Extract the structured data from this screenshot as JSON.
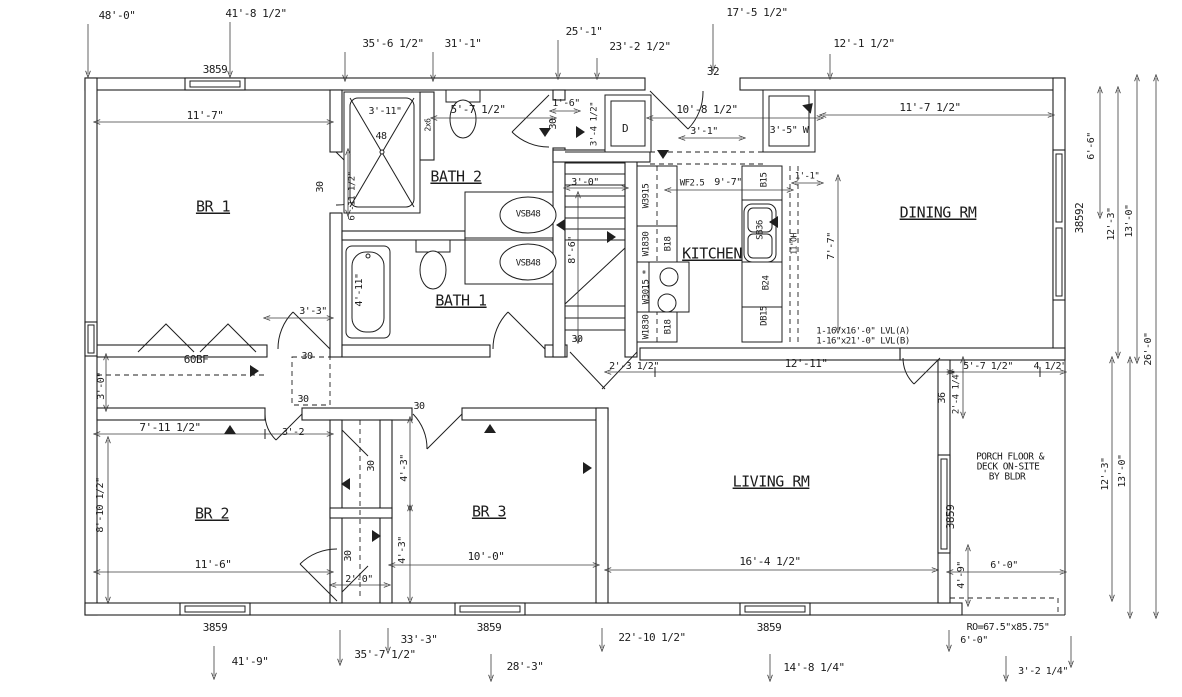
{
  "colors": {
    "line": "#1f1f1f",
    "dim": "#3c3c3c",
    "bg": "#ffffff"
  },
  "drawing": {
    "type": "residential-floor-plan"
  },
  "labels": [
    {
      "k": "dim",
      "t": "48'-0\"",
      "x": 117,
      "y": 16,
      "s": 11
    },
    {
      "k": "dim",
      "t": "41'-8 1/2\"",
      "x": 256,
      "y": 14,
      "s": 11
    },
    {
      "k": "dim",
      "t": "35'-6 1/2\"",
      "x": 393,
      "y": 44,
      "s": 11
    },
    {
      "k": "dim",
      "t": "31'-1\"",
      "x": 463,
      "y": 44,
      "s": 11
    },
    {
      "k": "dim",
      "t": "25'-1\"",
      "x": 584,
      "y": 32,
      "s": 11
    },
    {
      "k": "dim",
      "t": "23'-2 1/2\"",
      "x": 640,
      "y": 47,
      "s": 11
    },
    {
      "k": "dim",
      "t": "17'-5 1/2\"",
      "x": 757,
      "y": 13,
      "s": 11
    },
    {
      "k": "dim",
      "t": "12'-1 1/2\"",
      "x": 864,
      "y": 44,
      "s": 11
    },
    {
      "k": "door-size",
      "t": "32",
      "x": 713,
      "y": 72,
      "s": 11
    },
    {
      "k": "window",
      "t": "3859",
      "x": 215,
      "y": 70,
      "s": 11
    },
    {
      "k": "window",
      "t": "3859",
      "x": 215,
      "y": 628,
      "s": 11
    },
    {
      "k": "window",
      "t": "3859",
      "x": 489,
      "y": 628,
      "s": 11
    },
    {
      "k": "window",
      "t": "3859",
      "x": 769,
      "y": 628,
      "s": 11
    },
    {
      "k": "window",
      "t": "3859",
      "x": 951,
      "y": 517,
      "r": -90,
      "s": 11
    },
    {
      "k": "window",
      "t": "38592",
      "x": 1080,
      "y": 218,
      "r": -90,
      "s": 11
    },
    {
      "k": "room",
      "t": "BR 1",
      "x": 213,
      "y": 207,
      "s": 15,
      "u": 1
    },
    {
      "k": "room",
      "t": "BATH 2",
      "x": 456,
      "y": 177,
      "s": 15,
      "u": 1
    },
    {
      "k": "room",
      "t": "BATH 1",
      "x": 461,
      "y": 301,
      "s": 15,
      "u": 1
    },
    {
      "k": "room",
      "t": "KITCHEN",
      "x": 712,
      "y": 254,
      "s": 15,
      "u": 1
    },
    {
      "k": "room",
      "t": "DINING RM",
      "x": 938,
      "y": 213,
      "s": 15,
      "u": 1
    },
    {
      "k": "room",
      "t": "BR 2",
      "x": 212,
      "y": 514,
      "s": 15,
      "u": 1
    },
    {
      "k": "room",
      "t": "BR 3",
      "x": 489,
      "y": 512,
      "s": 15,
      "u": 1
    },
    {
      "k": "room",
      "t": "LIVING RM",
      "x": 771,
      "y": 482,
      "s": 15,
      "u": 1
    },
    {
      "k": "dim",
      "t": "11'-7\"",
      "x": 205,
      "y": 116,
      "s": 11
    },
    {
      "k": "dim",
      "t": "3'-11\"",
      "x": 385,
      "y": 111,
      "s": 10
    },
    {
      "k": "note",
      "t": "48",
      "x": 381,
      "y": 136,
      "s": 10
    },
    {
      "k": "dim",
      "t": "5'-7 1/2\"",
      "x": 478,
      "y": 110,
      "s": 11
    },
    {
      "k": "dim",
      "t": "1'-6\"",
      "x": 566,
      "y": 103,
      "s": 10
    },
    {
      "k": "dim",
      "t": "10'-8 1/2\"",
      "x": 707,
      "y": 110,
      "s": 11
    },
    {
      "k": "dim",
      "t": "3'-1\"",
      "x": 704,
      "y": 131,
      "s": 10
    },
    {
      "k": "note",
      "t": "3'-5\" W",
      "x": 789,
      "y": 130,
      "s": 10
    },
    {
      "k": "dim",
      "t": "11'-7 1/2\"",
      "x": 930,
      "y": 108,
      "s": 11
    },
    {
      "k": "note",
      "t": "WF2.5",
      "x": 692,
      "y": 183,
      "s": 9
    },
    {
      "k": "dim",
      "t": "9'-7\"",
      "x": 728,
      "y": 182,
      "s": 10
    },
    {
      "k": "dim",
      "t": "1'-1\"",
      "x": 807,
      "y": 176,
      "s": 9
    },
    {
      "k": "dim",
      "t": "3'-0\"",
      "x": 585,
      "y": 182,
      "s": 10
    },
    {
      "k": "dim",
      "t": "2'-3 1/2\"",
      "x": 634,
      "y": 366,
      "s": 10
    },
    {
      "k": "dim",
      "t": "12'-11\"",
      "x": 806,
      "y": 364,
      "s": 11
    },
    {
      "k": "dim",
      "t": "5'-7 1/2\"",
      "x": 988,
      "y": 366,
      "s": 10
    },
    {
      "k": "dim",
      "t": "4 1/2\"",
      "x": 1050,
      "y": 366,
      "s": 10
    },
    {
      "k": "dim",
      "t": "7'-11 1/2\"",
      "x": 170,
      "y": 428,
      "s": 11
    },
    {
      "k": "dim",
      "t": "3'-2",
      "x": 293,
      "y": 432,
      "s": 10
    },
    {
      "k": "dim",
      "t": "3'-3\"",
      "x": 313,
      "y": 311,
      "s": 10
    },
    {
      "k": "dim",
      "t": "11'-6\"",
      "x": 213,
      "y": 565,
      "s": 11
    },
    {
      "k": "dim",
      "t": "10'-0\"",
      "x": 486,
      "y": 557,
      "s": 11
    },
    {
      "k": "dim",
      "t": "16'-4 1/2\"",
      "x": 770,
      "y": 562,
      "s": 11
    },
    {
      "k": "dim",
      "t": "2'-0\"",
      "x": 359,
      "y": 579,
      "s": 10
    },
    {
      "k": "note",
      "t": "60BF",
      "x": 196,
      "y": 360,
      "s": 11
    },
    {
      "k": "dim",
      "t": "6'-0\"",
      "x": 1004,
      "y": 565,
      "s": 10
    },
    {
      "k": "note",
      "t": "RO=67.5\"x85.75\"",
      "x": 1008,
      "y": 627,
      "s": 10
    },
    {
      "k": "dim",
      "t": "6'-0\"",
      "x": 974,
      "y": 640,
      "s": 10
    },
    {
      "k": "dim",
      "t": "3'-2 1/4\"",
      "x": 1043,
      "y": 671,
      "s": 10
    },
    {
      "k": "dim",
      "t": "41'-9\"",
      "x": 250,
      "y": 662,
      "s": 11
    },
    {
      "k": "dim",
      "t": "35'-7 1/2\"",
      "x": 385,
      "y": 655,
      "s": 11
    },
    {
      "k": "dim",
      "t": "33'-3\"",
      "x": 419,
      "y": 640,
      "s": 11
    },
    {
      "k": "dim",
      "t": "28'-3\"",
      "x": 525,
      "y": 667,
      "s": 11
    },
    {
      "k": "dim",
      "t": "22'-10 1/2\"",
      "x": 652,
      "y": 638,
      "s": 11
    },
    {
      "k": "dim",
      "t": "14'-8 1/4\"",
      "x": 814,
      "y": 668,
      "s": 11
    },
    {
      "k": "dim",
      "t": "6'-11 1/2\"",
      "x": 352,
      "y": 196,
      "r": -90,
      "s": 9
    },
    {
      "k": "door-size",
      "t": "30",
      "x": 320,
      "y": 187,
      "r": -90,
      "s": 10
    },
    {
      "k": "door-size",
      "t": "30",
      "x": 553,
      "y": 124,
      "r": -90,
      "s": 10
    },
    {
      "k": "dim",
      "t": "3'-4 1/2\"",
      "x": 594,
      "y": 124,
      "r": -90,
      "s": 9
    },
    {
      "k": "note",
      "t": "2x6",
      "x": 428,
      "y": 125,
      "r": -90,
      "s": 8
    },
    {
      "k": "dim",
      "t": "8'-6\"",
      "x": 572,
      "y": 250,
      "r": -90,
      "s": 10
    },
    {
      "k": "dim",
      "t": "4'-11\"",
      "x": 359,
      "y": 290,
      "r": -90,
      "s": 10
    },
    {
      "k": "dim",
      "t": "3'-0\"",
      "x": 101,
      "y": 386,
      "r": -90,
      "s": 10
    },
    {
      "k": "dim",
      "t": "8'-10 1/2\"",
      "x": 100,
      "y": 505,
      "r": -90,
      "s": 10
    },
    {
      "k": "door-size",
      "t": "30",
      "x": 371,
      "y": 466,
      "r": -90,
      "s": 10
    },
    {
      "k": "dim",
      "t": "4'-3\"",
      "x": 404,
      "y": 468,
      "r": -90,
      "s": 10
    },
    {
      "k": "dim",
      "t": "4'-3\"",
      "x": 402,
      "y": 550,
      "r": -90,
      "s": 10
    },
    {
      "k": "door-size",
      "t": "30",
      "x": 348,
      "y": 556,
      "r": -90,
      "s": 10
    },
    {
      "k": "dim",
      "t": "6'-6\"",
      "x": 1091,
      "y": 146,
      "r": -90,
      "s": 10
    },
    {
      "k": "dim",
      "t": "12'-3\"",
      "x": 1111,
      "y": 224,
      "r": -90,
      "s": 10
    },
    {
      "k": "dim",
      "t": "13'-0\"",
      "x": 1129,
      "y": 221,
      "r": -90,
      "s": 10
    },
    {
      "k": "dim",
      "t": "26'-0\"",
      "x": 1148,
      "y": 349,
      "r": -90,
      "s": 10
    },
    {
      "k": "dim",
      "t": "12'-3\"",
      "x": 1105,
      "y": 474,
      "r": -90,
      "s": 10
    },
    {
      "k": "dim",
      "t": "13'-0\"",
      "x": 1122,
      "y": 471,
      "r": -90,
      "s": 10
    },
    {
      "k": "dim",
      "t": "4'-9\"",
      "x": 961,
      "y": 575,
      "r": -90,
      "s": 10
    },
    {
      "k": "note",
      "t": "11\"OH",
      "x": 794,
      "y": 244,
      "r": -90,
      "s": 8
    },
    {
      "k": "dim",
      "t": "7'-7\"",
      "x": 831,
      "y": 246,
      "r": -90,
      "s": 10
    },
    {
      "k": "dim",
      "t": "36",
      "x": 942,
      "y": 398,
      "r": -90,
      "s": 10
    },
    {
      "k": "dim",
      "t": "2'-4 1/4\"",
      "x": 956,
      "y": 392,
      "r": -90,
      "s": 9
    },
    {
      "k": "cabinet",
      "t": "B15",
      "x": 764,
      "y": 180,
      "r": -90,
      "s": 9
    },
    {
      "k": "cabinet",
      "t": "SB36",
      "x": 760,
      "y": 230,
      "r": -90,
      "s": 9
    },
    {
      "k": "cabinet",
      "t": "B24",
      "x": 766,
      "y": 283,
      "r": -90,
      "s": 9
    },
    {
      "k": "cabinet",
      "t": "DB15",
      "x": 764,
      "y": 316,
      "r": -90,
      "s": 9
    },
    {
      "k": "cabinet",
      "t": "W3915",
      "x": 646,
      "y": 196,
      "r": -90,
      "s": 9
    },
    {
      "k": "cabinet",
      "t": "W1830",
      "x": 646,
      "y": 244,
      "r": -90,
      "s": 9
    },
    {
      "k": "cabinet",
      "t": "B18",
      "x": 668,
      "y": 244,
      "r": -90,
      "s": 9
    },
    {
      "k": "cabinet",
      "t": "W3015 *",
      "x": 646,
      "y": 287,
      "r": -90,
      "s": 9
    },
    {
      "k": "cabinet",
      "t": "W1830",
      "x": 646,
      "y": 327,
      "r": -90,
      "s": 9
    },
    {
      "k": "cabinet",
      "t": "B18",
      "x": 668,
      "y": 327,
      "r": -90,
      "s": 9
    },
    {
      "k": "door-size",
      "t": "30",
      "x": 307,
      "y": 356,
      "s": 10
    },
    {
      "k": "door-size",
      "t": "30",
      "x": 303,
      "y": 399,
      "s": 10
    },
    {
      "k": "door-size",
      "t": "30",
      "x": 419,
      "y": 406,
      "s": 10
    },
    {
      "k": "door-size",
      "t": "30",
      "x": 577,
      "y": 339,
      "s": 10
    },
    {
      "k": "fixture",
      "t": "D",
      "x": 625,
      "y": 129,
      "s": 11
    },
    {
      "k": "fixture",
      "t": "VSB48",
      "x": 528,
      "y": 214,
      "s": 9
    },
    {
      "k": "fixture",
      "t": "VSB48",
      "x": 528,
      "y": 263,
      "s": 9
    },
    {
      "k": "note",
      "t": "1-16\"x16'-0\" LVL(A)",
      "x": 863,
      "y": 331,
      "s": 9
    },
    {
      "k": "note",
      "t": "1-16\"x21'-0\" LVL(B)",
      "x": 863,
      "y": 341,
      "s": 9
    },
    {
      "k": "note",
      "t": "PORCH FLOOR &",
      "x": 1010,
      "y": 457,
      "s": 9.5
    },
    {
      "k": "note",
      "t": "DECK ON-SITE",
      "x": 1008,
      "y": 467,
      "s": 9.5
    },
    {
      "k": "note",
      "t": "BY BLDR",
      "x": 1007,
      "y": 477,
      "s": 9.5
    }
  ],
  "direction_marks": [
    [
      545,
      133,
      90
    ],
    [
      663,
      155,
      90
    ],
    [
      560,
      225,
      180
    ],
    [
      612,
      237,
      0
    ],
    [
      773,
      222,
      180
    ],
    [
      810,
      106,
      -45
    ],
    [
      490,
      428,
      -90
    ],
    [
      588,
      468,
      0
    ],
    [
      255,
      371,
      0
    ],
    [
      230,
      429,
      -90
    ],
    [
      345,
      484,
      180
    ],
    [
      377,
      536,
      0
    ],
    [
      581,
      132,
      0
    ]
  ]
}
